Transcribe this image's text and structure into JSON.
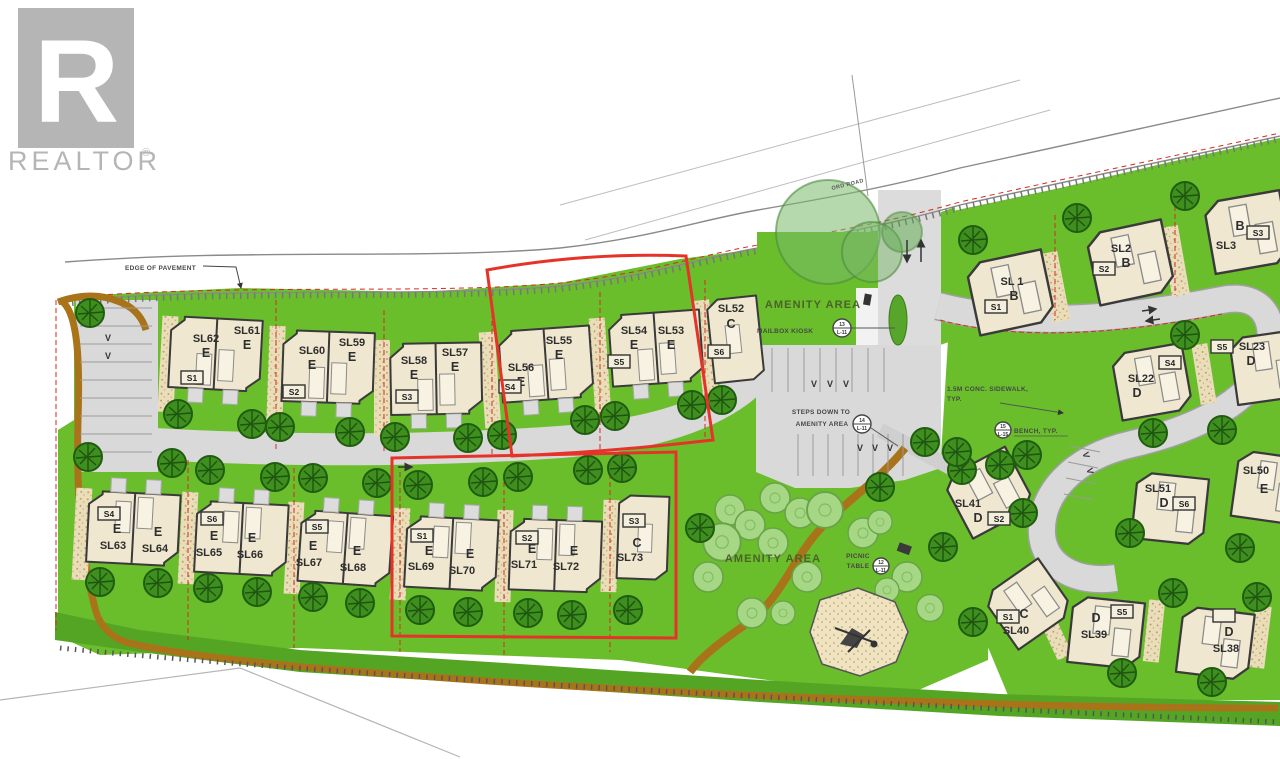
{
  "logo": {
    "mark": "R",
    "brand": "REALTOR",
    "reg": "®"
  },
  "annotations": {
    "edge_of_pavement": "EDGE OF PAVEMENT",
    "road": "ORD ROAD",
    "amenity_top": "AMENITY AREA",
    "mailbox": "MAILBOX KIOSK",
    "steps1": "STEPS DOWN TO",
    "steps2": "AMENITY AREA",
    "sidewalk1": "1.5M CONC. SIDEWALK,",
    "sidewalk2": "TYP.",
    "bench": "BENCH, TYP.",
    "amenity_bottom": "AMENITY AREA",
    "picnic1": "PICNIC",
    "picnic2": "TABLE",
    "visitor": "V"
  },
  "keynotes": {
    "mailbox_num": "13",
    "mailbox_sheet": "L-11",
    "steps_num": "14",
    "steps_sheet": "L-11",
    "picnic_num": "12",
    "picnic_sheet": "L-11",
    "bench_num": "15",
    "bench_sheet": "L-15"
  },
  "colors": {
    "grass": "#6abe2c",
    "grass_dark": "#55a524",
    "tree": "#3f8f1f",
    "lot_fill": "#efe7cf",
    "road": "#d9d9d9",
    "trail": "#a9731a",
    "highlight_red": "#e6332a",
    "logo_gray": "#b5b5b5"
  },
  "lots": {
    "top": [
      {
        "id": "SL62",
        "type": "E",
        "sbox": "S1"
      },
      {
        "id": "SL61",
        "type": "E"
      },
      {
        "id": "SL60",
        "type": "E",
        "sbox": "S2"
      },
      {
        "id": "SL59",
        "type": "E"
      },
      {
        "id": "SL58",
        "type": "E",
        "sbox": "S3"
      },
      {
        "id": "SL57",
        "type": "E"
      },
      {
        "id": "SL56",
        "type": "E",
        "sbox": "S4"
      },
      {
        "id": "SL55",
        "type": "E"
      },
      {
        "id": "SL54",
        "type": "E",
        "sbox": "S5"
      },
      {
        "id": "SL53",
        "type": "E"
      },
      {
        "id": "SL52",
        "type": "C",
        "sbox": "S6"
      }
    ],
    "bottom": [
      {
        "id": "SL63",
        "type": "E",
        "sbox": "S4"
      },
      {
        "id": "SL64",
        "type": "E"
      },
      {
        "id": "SL65",
        "type": "E",
        "sbox": "S6"
      },
      {
        "id": "SL66",
        "type": "E"
      },
      {
        "id": "SL67",
        "type": "E",
        "sbox": "S5"
      },
      {
        "id": "SL68",
        "type": "E"
      },
      {
        "id": "SL69",
        "type": "E",
        "sbox": "S1"
      },
      {
        "id": "SL70",
        "type": "E"
      },
      {
        "id": "SL71",
        "type": "E",
        "sbox": "S2"
      },
      {
        "id": "SL72",
        "type": "E"
      },
      {
        "id": "SL73",
        "type": "C",
        "sbox": "S3"
      }
    ],
    "right": [
      {
        "id": "SL 1",
        "type": "B",
        "sbox": "S1"
      },
      {
        "id": "SL2",
        "type": "B",
        "sbox": "S2"
      },
      {
        "id": "SL3",
        "type": "B",
        "sbox": "S3"
      },
      {
        "id": "SL22",
        "type": "D",
        "sbox": "S4"
      },
      {
        "id": "SL23",
        "type": "D",
        "sbox": "S5"
      },
      {
        "id": "SL50",
        "type": "E"
      },
      {
        "id": "SL51",
        "type": "D",
        "sbox": "S6"
      },
      {
        "id": "SL41",
        "type": "D",
        "sbox": "S2"
      },
      {
        "id": "SL40",
        "type": "C",
        "sbox": "S1"
      },
      {
        "id": "SL39",
        "type": "D",
        "sbox": "S5"
      },
      {
        "id": "SL38",
        "type": "D",
        "sbox": "S4"
      }
    ]
  }
}
